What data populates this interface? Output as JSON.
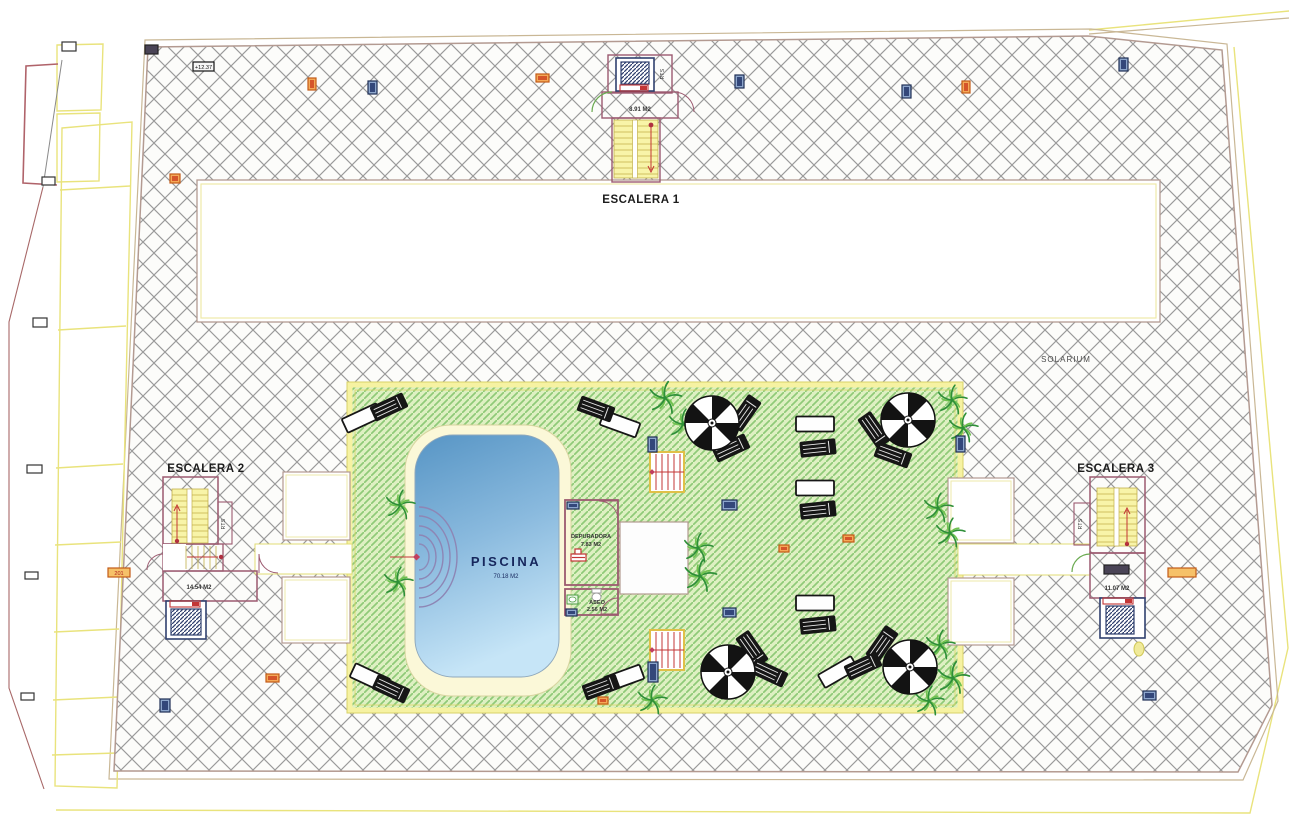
{
  "drawing": {
    "labels": {
      "escalera1": {
        "title": "ESCALERA 1",
        "area": "8.91 M2",
        "shaft": "RTS"
      },
      "escalera2": {
        "title": "ESCALERA 2",
        "area": "14.54 M2",
        "shaft": "RTS"
      },
      "escalera3": {
        "title": "ESCALERA 3",
        "area": "11.07 M2",
        "shaft": "RTS"
      },
      "solarium": "SOLARIUM",
      "pool": {
        "title": "PISCINA",
        "area": "70.18 M2"
      },
      "depuradora": {
        "title": "DEPURADORA",
        "area": "7.83 M2"
      },
      "aseo": {
        "title": "ASEO",
        "area": "2.56 M2"
      }
    },
    "colors": {
      "hatch_gray": "#9a9a9a",
      "deck_fill": "#def0c2",
      "deck_stripe": "#8fca78",
      "deck_border": "#f6f2a2",
      "pool_top": "#5795c5",
      "pool_bottom": "#c6e5f7",
      "wall_maroon": "#9c5a70",
      "stair_yellow": "#f8f4a8",
      "lift_navy": "#30406e",
      "red": "#c33636",
      "orange_marker": "#f4a958",
      "navy_marker": "#8da6cc",
      "boundary_yellow": "#e9e37c",
      "boundary_tan": "#c9b795",
      "pool_text": "#16265c"
    },
    "markers": [
      {
        "x": 62,
        "y": 42,
        "w": 14,
        "h": 9,
        "t": "white"
      },
      {
        "x": 42,
        "y": 177,
        "w": 13,
        "h": 8,
        "t": "white"
      },
      {
        "x": 33,
        "y": 318,
        "w": 14,
        "h": 9,
        "t": "white"
      },
      {
        "x": 27,
        "y": 465,
        "w": 15,
        "h": 8,
        "t": "white"
      },
      {
        "x": 25,
        "y": 572,
        "w": 13,
        "h": 7,
        "t": "white"
      },
      {
        "x": 21,
        "y": 693,
        "w": 13,
        "h": 7,
        "t": "white"
      },
      {
        "x": 145,
        "y": 45,
        "w": 13,
        "h": 9,
        "t": "dark"
      },
      {
        "x": 193,
        "y": 62,
        "w": 21,
        "h": 9,
        "t": "labelDark",
        "text": "+12.37"
      },
      {
        "x": 308,
        "y": 78,
        "w": 8,
        "h": 12,
        "t": "orange"
      },
      {
        "x": 368,
        "y": 81,
        "w": 9,
        "h": 13,
        "t": "navy"
      },
      {
        "x": 536,
        "y": 74,
        "w": 13,
        "h": 8,
        "t": "orange"
      },
      {
        "x": 735,
        "y": 75,
        "w": 9,
        "h": 13,
        "t": "navy"
      },
      {
        "x": 902,
        "y": 85,
        "w": 9,
        "h": 13,
        "t": "navy"
      },
      {
        "x": 962,
        "y": 81,
        "w": 8,
        "h": 12,
        "t": "orange"
      },
      {
        "x": 1119,
        "y": 58,
        "w": 9,
        "h": 13,
        "t": "navy"
      },
      {
        "x": 170,
        "y": 174,
        "w": 10,
        "h": 9,
        "t": "orange"
      },
      {
        "x": 108,
        "y": 568,
        "w": 22,
        "h": 9,
        "t": "labelOrange",
        "text": "201"
      },
      {
        "x": 266,
        "y": 674,
        "w": 13,
        "h": 8,
        "t": "orange"
      },
      {
        "x": 160,
        "y": 699,
        "w": 10,
        "h": 13,
        "t": "navy"
      },
      {
        "x": 598,
        "y": 697,
        "w": 10,
        "h": 7,
        "t": "orange"
      },
      {
        "x": 843,
        "y": 535,
        "w": 11,
        "h": 7,
        "t": "orange"
      },
      {
        "x": 779,
        "y": 545,
        "w": 10,
        "h": 7,
        "t": "orange"
      },
      {
        "x": 1168,
        "y": 568,
        "w": 28,
        "h": 9,
        "t": "labelOrange",
        "text": ""
      },
      {
        "x": 1143,
        "y": 691,
        "w": 13,
        "h": 9,
        "t": "navy"
      },
      {
        "x": 648,
        "y": 437,
        "w": 9,
        "h": 15,
        "t": "navy"
      },
      {
        "x": 722,
        "y": 500,
        "w": 15,
        "h": 10,
        "t": "navy"
      },
      {
        "x": 723,
        "y": 608,
        "w": 13,
        "h": 9,
        "t": "navy"
      },
      {
        "x": 648,
        "y": 662,
        "w": 10,
        "h": 20,
        "t": "navy"
      },
      {
        "x": 956,
        "y": 436,
        "w": 9,
        "h": 16,
        "t": "navy"
      },
      {
        "x": 567,
        "y": 502,
        "w": 12,
        "h": 7,
        "t": "navy"
      },
      {
        "x": 566,
        "y": 609,
        "w": 11,
        "h": 7,
        "t": "navy"
      },
      {
        "x": 1104,
        "y": 565,
        "w": 25,
        "h": 9,
        "t": "dark"
      },
      {
        "x": 1134,
        "y": 642,
        "w": 10,
        "h": 14,
        "t": "yellowEllipse"
      }
    ],
    "palms": [
      [
        400,
        505
      ],
      [
        398,
        582
      ],
      [
        665,
        398,
        1.1
      ],
      [
        683,
        424
      ],
      [
        698,
        548
      ],
      [
        700,
        576,
        1.1
      ],
      [
        938,
        508
      ],
      [
        950,
        533
      ],
      [
        952,
        400
      ],
      [
        963,
        428
      ],
      [
        940,
        645
      ],
      [
        953,
        678,
        1.1
      ],
      [
        929,
        701
      ],
      [
        652,
        700
      ]
    ],
    "parasols": [
      [
        712,
        423
      ],
      [
        908,
        420
      ],
      [
        728,
        672
      ],
      [
        910,
        667
      ]
    ],
    "white_loungers": [
      [
        362,
        418,
        -25
      ],
      [
        620,
        424,
        20
      ],
      [
        815,
        424,
        0
      ],
      [
        815,
        488,
        0
      ],
      [
        815,
        603,
        0
      ],
      [
        370,
        678,
        25
      ],
      [
        624,
        678,
        -20
      ],
      [
        838,
        672,
        -30
      ]
    ],
    "black_loungers": [
      [
        389,
        407,
        -25
      ],
      [
        596,
        409,
        20
      ],
      [
        818,
        448,
        -6
      ],
      [
        818,
        510,
        -6
      ],
      [
        818,
        625,
        -6
      ],
      [
        391,
        689,
        25
      ],
      [
        601,
        687,
        -20
      ],
      [
        745,
        413,
        -55
      ],
      [
        731,
        448,
        -25
      ],
      [
        874,
        430,
        55
      ],
      [
        893,
        455,
        20
      ],
      [
        752,
        649,
        55
      ],
      [
        769,
        673,
        25
      ],
      [
        882,
        644,
        -55
      ],
      [
        863,
        666,
        -25
      ]
    ]
  }
}
